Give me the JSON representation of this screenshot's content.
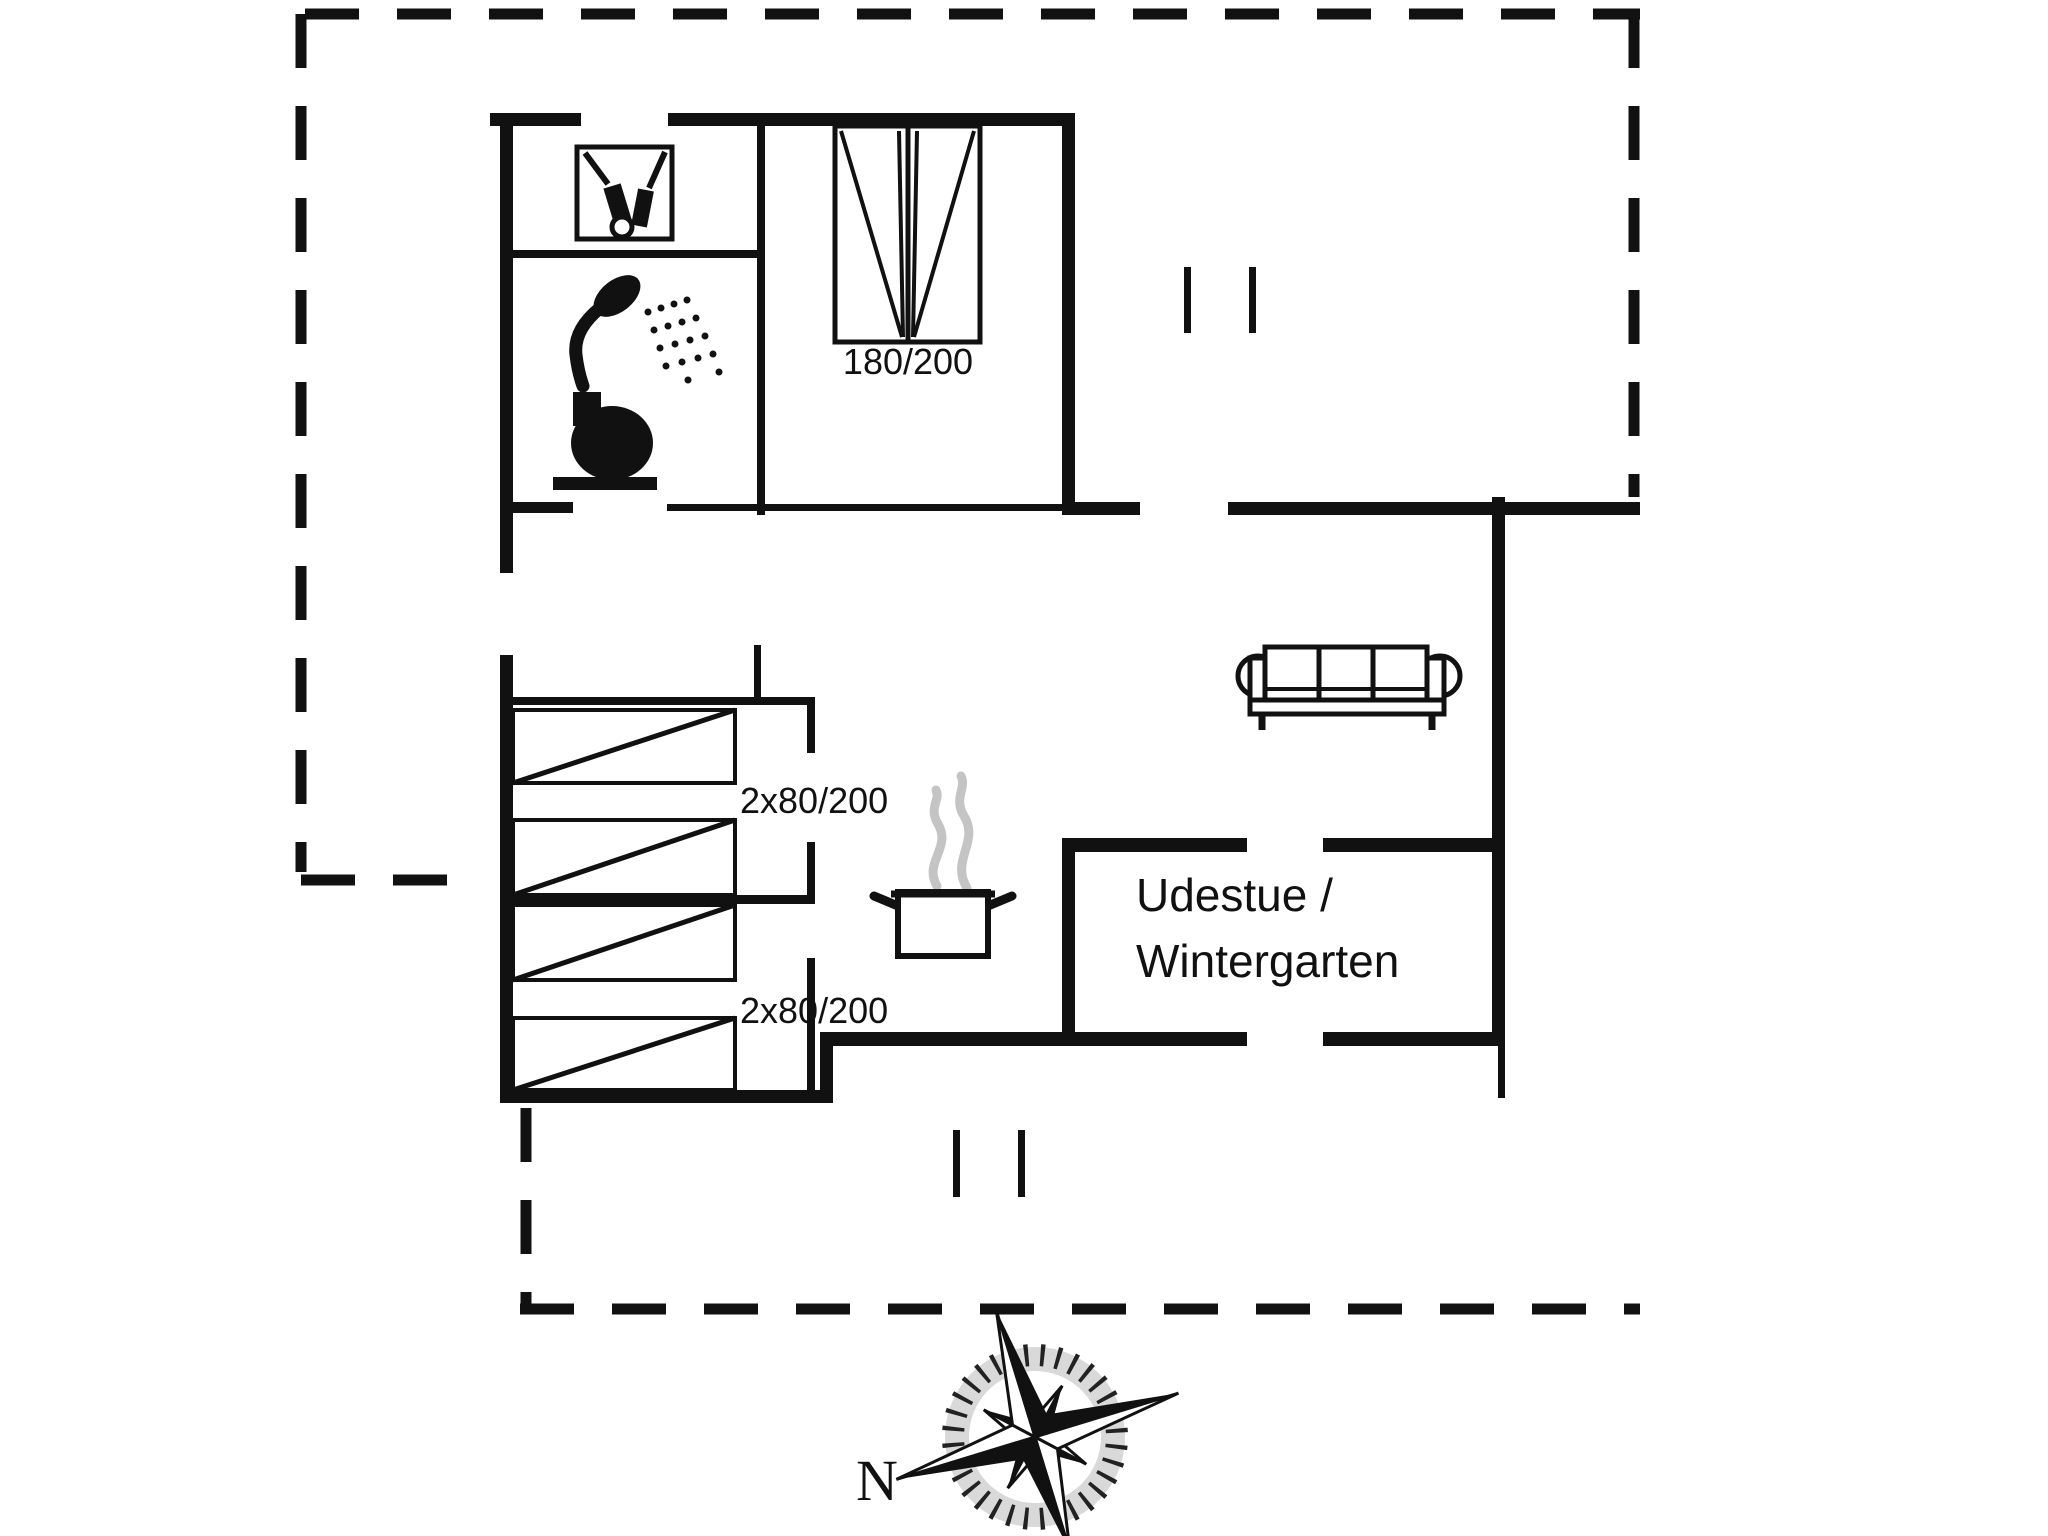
{
  "document": {
    "type": "floor-plan",
    "rooms_visible_label": "Udestue / Wintergarten",
    "compass_direction_shown": "N"
  },
  "colors": {
    "ink": "#111111",
    "background": "#ffffff",
    "steam": "#c4c4c4",
    "compass_shade": "#d9d9d9"
  },
  "labels": {
    "double_bed_size": "180/200",
    "bunk_top_size": "2x80/200",
    "bunk_bottom_size": "2x80/200",
    "sunroom_line1": "Udestue /",
    "sunroom_line2": "Wintergarten",
    "compass_north": "N"
  },
  "icons": [
    {
      "name": "washing-machine-icon"
    },
    {
      "name": "shower-icon"
    },
    {
      "name": "toilet-icon"
    },
    {
      "name": "double-bed-icon"
    },
    {
      "name": "bunk-bed-icon"
    },
    {
      "name": "cooking-pot-icon"
    },
    {
      "name": "sofa-icon"
    },
    {
      "name": "compass-rose-icon"
    }
  ]
}
